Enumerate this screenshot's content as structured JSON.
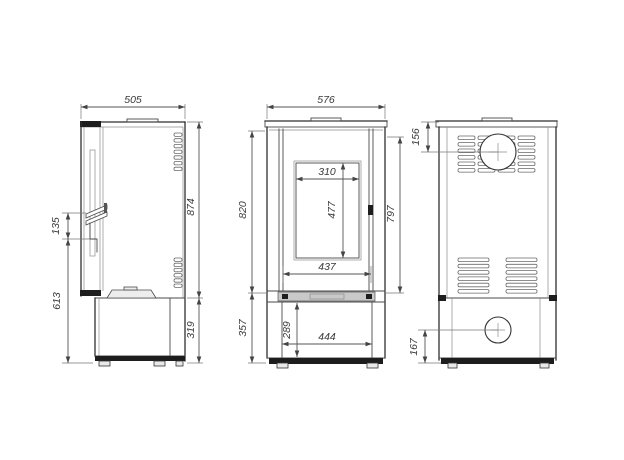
{
  "drawing": {
    "kind": "stove-technical-drawing",
    "colors": {
      "background": "#ffffff",
      "outline": "#2f2f2f",
      "dimension_lines": "#555555",
      "dimension_text": "#3a3a3a"
    }
  },
  "views": {
    "side": {
      "dims": {
        "depth": "505",
        "body_height": "874",
        "base_height": "319",
        "handle_span": "135",
        "handle_height_from_floor": "613"
      }
    },
    "front": {
      "dims": {
        "width": "576",
        "body_height": "820",
        "door_height": "797",
        "glass_width": "310",
        "glass_height": "477",
        "door_width": "437",
        "base_height": "357",
        "base_opening_height": "289",
        "base_opening_width": "444"
      }
    },
    "back": {
      "dims": {
        "flue_center_from_top": "156",
        "inlet_center_from_bottom": "167"
      }
    }
  }
}
